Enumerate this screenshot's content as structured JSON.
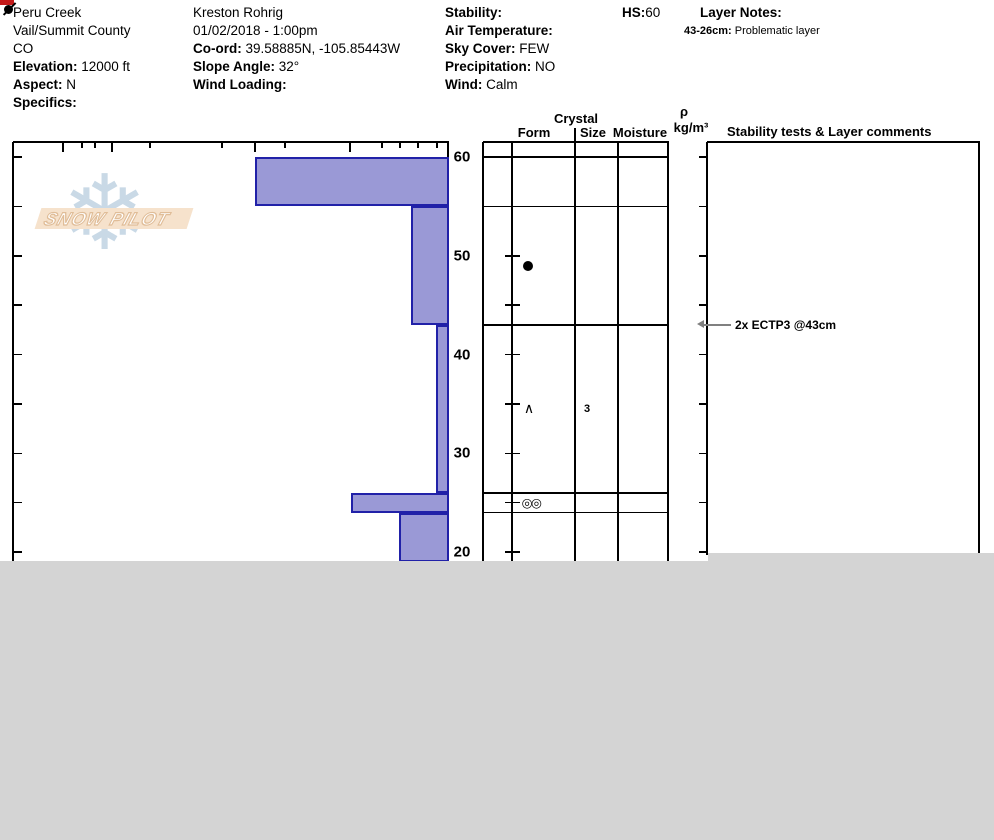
{
  "header": {
    "columns": [
      {
        "lines": [
          {
            "text": "Peru Creek"
          },
          {
            "text": "Vail/Summit County"
          },
          {
            "text": "CO"
          },
          {
            "label": "Elevation:",
            "text": "12000 ft"
          },
          {
            "label": "Aspect:",
            "text": "N"
          },
          {
            "label": "Specifics:",
            "text": ""
          }
        ]
      },
      {
        "lines": [
          {
            "text": "Kreston Rohrig"
          },
          {
            "text": "01/02/2018 - 1:00pm"
          },
          {
            "label": "Co-ord:",
            "text": "39.58885N, -105.85443W"
          },
          {
            "label": "Slope Angle:",
            "text": "32°"
          },
          {
            "label": "Wind Loading:",
            "text": ""
          }
        ]
      },
      {
        "lines": [
          {
            "label": "Stability:",
            "text": ""
          },
          {
            "label": "Air Temperature:",
            "text": ""
          },
          {
            "label": "Sky Cover:",
            "text": "FEW"
          },
          {
            "label": "Precipitation:",
            "text": "NO"
          },
          {
            "label": "Wind:",
            "text": "Calm"
          }
        ]
      },
      {
        "lines": [
          {
            "label": "HS:",
            "text": "60",
            "tight": true
          }
        ]
      },
      {
        "lines": [
          {
            "label": "Layer Notes:",
            "text": ""
          },
          {
            "label": "43-26cm:",
            "text": "Problematic layer",
            "small": true
          }
        ]
      }
    ]
  },
  "logo": {
    "text": "SNOW PILOT",
    "snowflake_icon": "❄"
  },
  "table_headers": {
    "crystal": "Crystal",
    "form": "Form",
    "size": "Size",
    "moisture": "Moisture",
    "rho": "ρ",
    "rho_units": "kg/m³",
    "stability": "Stability tests & Layer comments"
  },
  "chart_data": {
    "type": "bar",
    "title": "Snow pit hardness profile (horizontal bars) with grain form, size, moisture and density columns",
    "depth_unit": "cm",
    "depth_labels": [
      60,
      50,
      40,
      30,
      20
    ],
    "depth_tick_interval": 5,
    "surface_depth": 60,
    "visible_bottom_depth": 19,
    "hardness_axis_ticks_px": {
      "long": [
        63,
        112,
        255,
        350
      ],
      "short": [
        82,
        95,
        150,
        222,
        285,
        382,
        400,
        418,
        437
      ]
    },
    "layers": [
      {
        "top_cm": 60,
        "bottom_cm": 55,
        "bar_left_px": 255,
        "form_symbol": "slashed-dot"
      },
      {
        "top_cm": 55,
        "bottom_cm": 43,
        "bar_left_px": 411,
        "form_symbol": "dot"
      },
      {
        "top_cm": 43,
        "bottom_cm": 26,
        "bar_left_px": 436,
        "form_symbol": "caret",
        "grain_size": "3",
        "flag_color": "#c41a1a"
      },
      {
        "top_cm": 26,
        "bottom_cm": 24,
        "bar_left_px": 351,
        "form_symbol": "double-circle"
      },
      {
        "top_cm": 24,
        "bottom_cm": 19,
        "bar_left_px": 399
      }
    ],
    "tests": [
      {
        "label": "2x ECTP3 @43cm",
        "depth_cm": 43
      }
    ],
    "colors": {
      "bar_fill": "#9a99d6",
      "bar_border": "#2121a8",
      "flag_red": "#c41a1a",
      "arrow_gray": "#808080",
      "cropped_gray": "#d4d4d4",
      "logo_band": "#f6e2cc",
      "logo_snowflake": "#c9d9e6"
    }
  }
}
